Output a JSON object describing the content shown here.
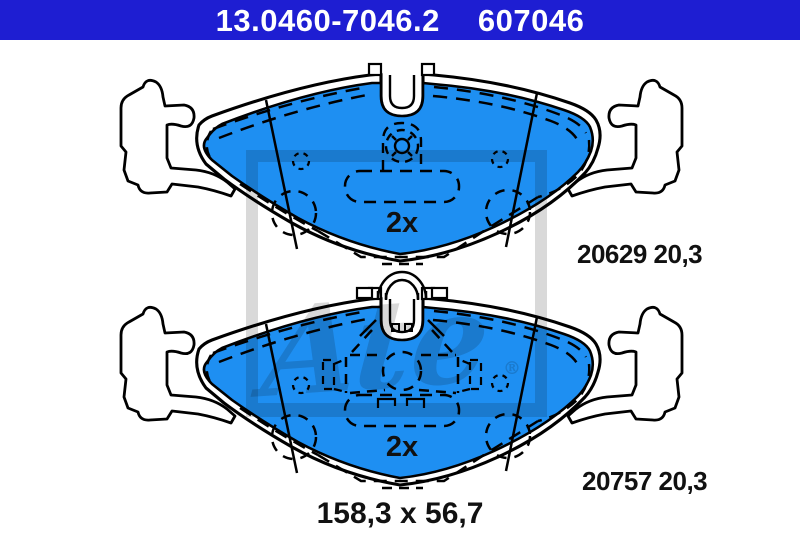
{
  "header": {
    "part_number": "13.0460-7046.2",
    "wva_number": "607046"
  },
  "pads": {
    "top": {
      "quantity": "2x",
      "backing_plate_ref": "20629 20,3"
    },
    "bottom": {
      "quantity": "2x",
      "backing_plate_ref": "20757 20,3"
    }
  },
  "dimensions": "158,3 x 56,7",
  "watermark": {
    "text": "Ate",
    "registered": "®"
  },
  "colors": {
    "header_bg": "#1e1ed2",
    "pad_blue": "#1e8ff2",
    "watermark_grey": "#d9d9d9",
    "line_black": "#111111"
  }
}
